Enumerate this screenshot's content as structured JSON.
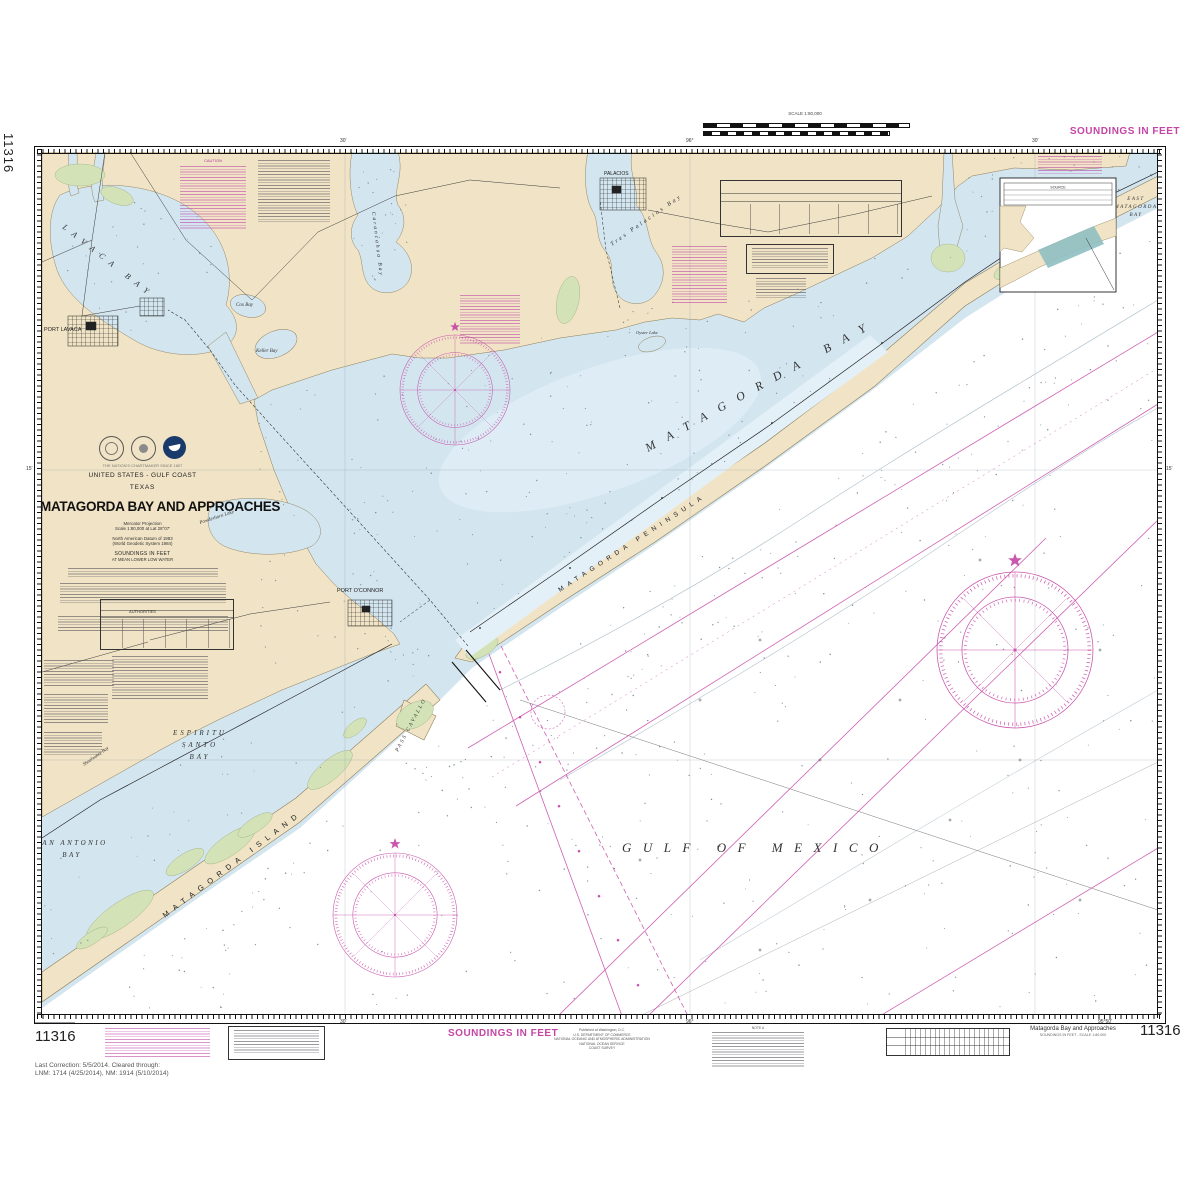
{
  "colors": {
    "magenta": "#c445a5",
    "land": "#f1e4c6",
    "water": "#d3e5ef",
    "marsh": "#d4e2b8",
    "teal": "#8fbfc2"
  },
  "chart_number": "11316",
  "header": {
    "soundings": "SOUNDINGS IN FEET",
    "scale": "SCALE 1:80,000"
  },
  "footer": {
    "soundings": "SOUNDINGS IN FEET",
    "last_correction_1": "Last Correction: 5/5/2014.  Cleared through:",
    "last_correction_2": "LNM: 1714 (4/25/2014), NM: 1914 (5/10/2014)",
    "publisher": [
      "Published at Washington, D.C.",
      "U.S. DEPARTMENT OF COMMERCE",
      "NATIONAL OCEANIC AND ATMOSPHERIC ADMINISTRATION",
      "NATIONAL OCEAN SERVICE",
      "COAST SURVEY"
    ],
    "note_heading": "NOTE A",
    "title_small": "Matagorda Bay and Approaches",
    "subtitle_small": "SOUNDINGS IN FEET - SCALE 1:80,000"
  },
  "title_block": {
    "tagline": "THE NATION'S CHARTMAKER SINCE 1807",
    "region": "UNITED STATES - GULF COAST",
    "state": "TEXAS",
    "title": "MATAGORDA BAY AND APPROACHES",
    "proj1": "Mercator Projection",
    "proj2": "Scale 1:80,000 at Lat 28°07'",
    "datum1": "North American Datum of 1983",
    "datum2": "(World Geodetic System 1984)",
    "sound1": "SOUNDINGS IN FEET",
    "sound2": "AT MEAN LOWER LOW WATER",
    "authorities": "AUTHORITIES",
    "caution": "CAUTION"
  },
  "inset": {
    "source": "SOURCE"
  },
  "geo": {
    "gulf": "GULF OF MEXICO",
    "matagorda_bay": "MATAGORDA BAY",
    "lavaca_bay": "LAVACA BAY",
    "tres_palacios": "Tres Palacios Bay",
    "carancahua": "Carancahua Bay",
    "keller": "Keller Bay",
    "cox": "Cox Bay",
    "oyster": "Oyster Lake",
    "powderhorn": "Powderhorn Lake",
    "espiritu": [
      "ESPIRITU",
      "SANTO",
      "BAY"
    ],
    "san_antonio": [
      "SAN ANTONIO",
      "BAY"
    ],
    "east_matagorda": [
      "EAST",
      "MATAGORDA",
      "BAY"
    ],
    "matagorda_island": "MATAGORDA ISLAND",
    "matagorda_peninsula": "MATAGORDA PENINSULA",
    "pass_cavallo": "PASS CAVALLO",
    "port_oconnor": "PORT O'CONNOR",
    "port_lavaca": "PORT LAVACA",
    "palacios": "PALACIOS",
    "shoalwater": "Shoalwater Bay"
  },
  "graticule": {
    "t30": "30'",
    "d96": "96°",
    "t15": "15'",
    "d9550": "95°50'"
  }
}
